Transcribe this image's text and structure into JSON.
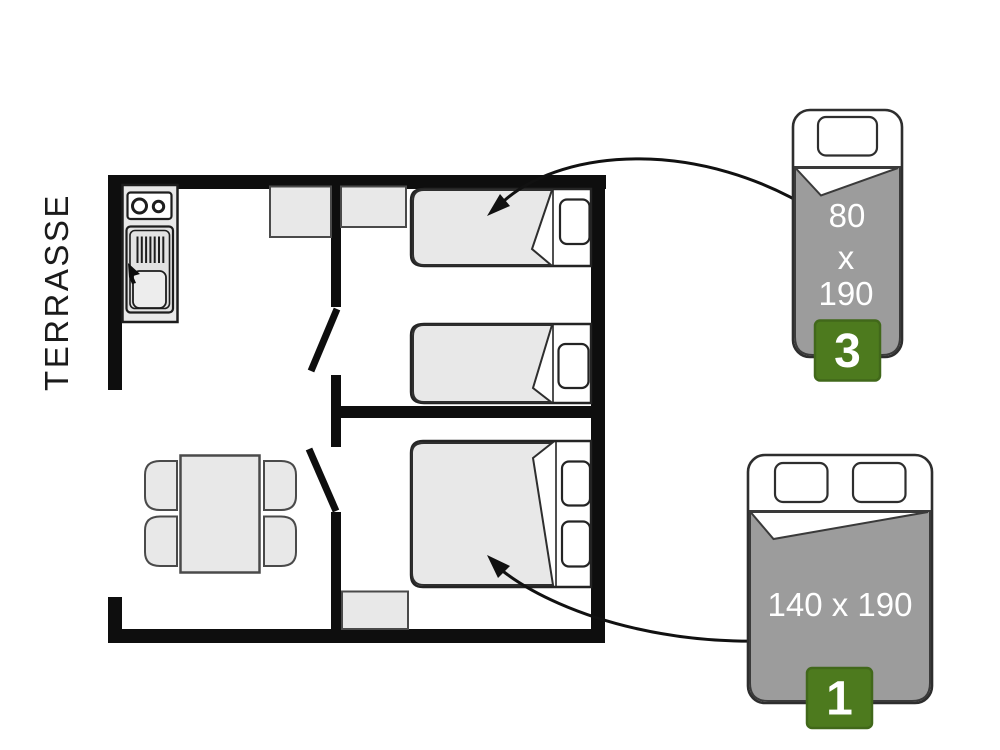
{
  "terrace": {
    "label": "TERRASSE"
  },
  "legend": {
    "single_bed": {
      "size_width": "80",
      "size_sep": "x",
      "size_length": "190",
      "count": "3"
    },
    "double_bed": {
      "size": "140 x 190",
      "count": "1"
    }
  },
  "colors": {
    "wall": "#0e0e0e",
    "arrow": "#111111",
    "furniture_fill": "#e8e8e8",
    "furniture_stroke": "#4a4a4a",
    "bed_stroke": "#242424",
    "blanket_gray": "#9c9c9c",
    "blanket_stroke": "#3a3a3a",
    "badge_green": "#4d7a1e",
    "badge_border": "#41681a",
    "label_white": "#ffffff",
    "terrace_text": "#1b1b1b"
  }
}
